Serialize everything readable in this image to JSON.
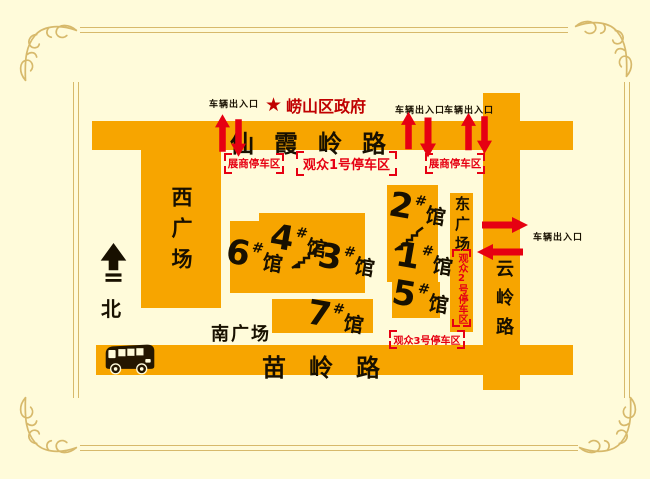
{
  "colors": {
    "background": "#FFFBDA",
    "area_orange": "#F7A500",
    "accent_red": "#E60012",
    "frame_gold": "#D7B96B",
    "text_black": "#181000"
  },
  "landmark": {
    "star_icon": "★",
    "name": "崂山区政府"
  },
  "roads": {
    "xianxia": "仙霞岭路",
    "yunling": "云岭路",
    "miaoling": "苗岭路"
  },
  "squares": {
    "west": "西广场",
    "east": "东广场",
    "south": "南广场"
  },
  "compass": {
    "north_label": "北"
  },
  "entrance_label": "车辆出入口",
  "halls": [
    {
      "num": "6",
      "hash": "#",
      "unit": "馆"
    },
    {
      "num": "4",
      "hash": "#",
      "unit": "馆"
    },
    {
      "num": "3",
      "hash": "#",
      "unit": "馆"
    },
    {
      "num": "2",
      "hash": "#",
      "unit": "馆"
    },
    {
      "num": "1",
      "hash": "#",
      "unit": "馆"
    },
    {
      "num": "5",
      "hash": "#",
      "unit": "馆"
    },
    {
      "num": "7",
      "hash": "#",
      "unit": "馆"
    }
  ],
  "parking": {
    "exhibitor_west": "展商停车区",
    "exhibitor_east": "展商停车区",
    "visitor1": "观众1号停车区",
    "visitor2": "观众2号停车区",
    "visitor3": "观众3号停车区"
  }
}
